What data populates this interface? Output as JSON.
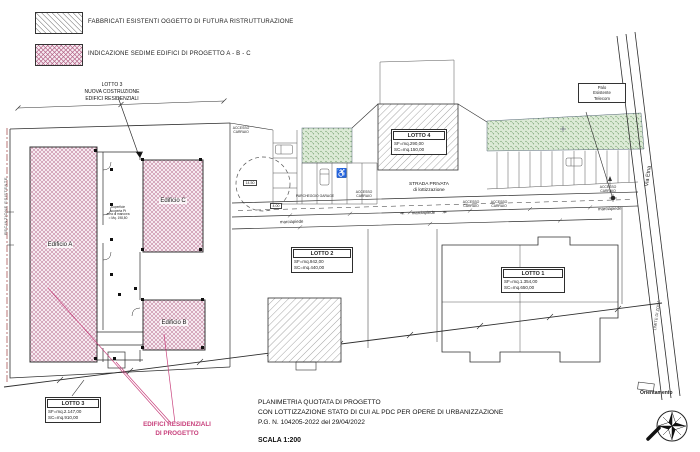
{
  "colors": {
    "accent_magenta": "#c8407c",
    "hatch_pink": "#b76a8c",
    "hatch_gray": "#9a9a9a",
    "green_area": "#6e9e68",
    "line": "#2e2e2e"
  },
  "legend": {
    "items": [
      {
        "id": "existing-buildings",
        "label": "FABBRICATI ESISTENTI OGGETTO DI FUTURA RISTRUTTURAZIONE"
      },
      {
        "id": "project-buildings",
        "label": "INDICAZIONE SEDIME EDIFICI DI PROGETTO  A - B - C"
      }
    ]
  },
  "callouts": {
    "nuova_costruzione": "LOTTO 3\nNUOVA COSTRUZIONE\nEDIFICI RESIDENZIALI",
    "palo_telecom": "Palo\nEsistente\nTelecom",
    "edifici_progetto": "EDIFICI RESIDENZIALI\nDI PROGETTO"
  },
  "buildings": {
    "a": "Edificio A",
    "b": "Edificio B",
    "c": "Edificio C",
    "courtyard_note": "Superficie\nscoperta Pt\narea di manovra\n= Mq. 198,80"
  },
  "lots": {
    "lotto1": {
      "title": "LOTTO 1",
      "values": "SF=mq.1.354,00\nSC=mq.650,00"
    },
    "lotto2": {
      "title": "LOTTO 2",
      "values": "SF=mq.942,00\nSC=mq.440,00"
    },
    "lotto3": {
      "title": "LOTTO 3",
      "values": "SF=mq.2.147,00\nSC=mq.910,00"
    },
    "lotto4": {
      "title": "LOTTO 4",
      "values": "SF=mq.290,00\nSC=mq.150,00"
    }
  },
  "roads": {
    "strada_privata": "STRADA PRIVATA\ndi lottizzazione",
    "marciapiede": "marciapiede",
    "arrow_left": "≪",
    "arrow_right": "≫",
    "via_name": "Via Etna"
  },
  "boundaries": {
    "left": "RECINZIONE  ESISTENTE",
    "right": "LIMITE DI ZONA"
  },
  "site_labels": {
    "accesso_carraio": "ACCESSO\nCARRAIO",
    "parcheggio_garage": "PARCHEGGIO GARAGE",
    "handicap_icon": "♿"
  },
  "dimensions": {
    "circle_dim": "14.50",
    "road_dim": "4.00"
  },
  "title_block": {
    "line1": "PLANIMETRIA QUOTATA DI PROGETTO",
    "line2": "CON LOTTIZZAZIONE STATO DI CUI AL PDC PER OPERE DI URBANIZZAZIONE",
    "line3": "P.G. N. 104205-2022 del 29/04/2022",
    "scale": "SCALA 1:200"
  },
  "compass": {
    "label": "Orientamento"
  }
}
